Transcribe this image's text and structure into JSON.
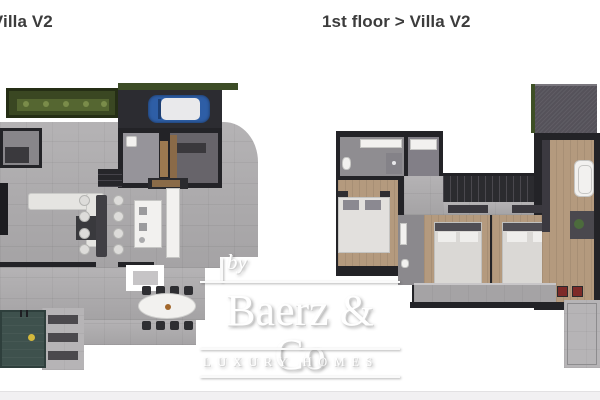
{
  "titles": {
    "left": "or > Villa V2",
    "right": "1st floor > Villa V2"
  },
  "watermark": {
    "prefix": "by",
    "brand": "Baerz & Co",
    "tagline": "LUXURY HOMES"
  },
  "colors": {
    "title_text": "#3c3c3c",
    "wall_dark": "#232327",
    "concrete_floor": "#afadaf",
    "wood_floor": "#b49a7e",
    "planter_green": "#4d5e2f",
    "roof_gray": "#55525a",
    "pool_teal": "#3e514d",
    "car_blue": "#2f62a8",
    "lounger_red": "#7d2a28",
    "logo_white": "#ffffff"
  }
}
